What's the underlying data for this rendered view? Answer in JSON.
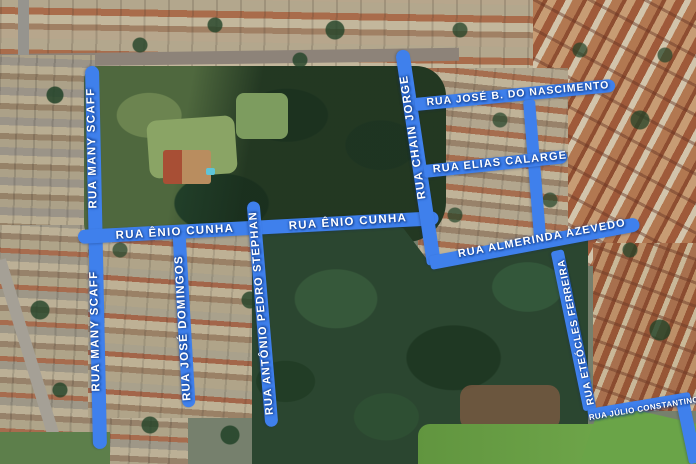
{
  "map": {
    "description": "Aerial satellite view with highlighted streets",
    "highlight_color": "#3f80ec",
    "label_text_color": "#ffffff",
    "street_names": [
      "RUA MANY SCAFF",
      "RUA ÊNIO CUNHA",
      "RUA JOSÉ DOMINGOS",
      "RUA ANTÔNIO PEDRO STEPHAN",
      "RUA CHAIN JORGE",
      "RUA JOSÉ B. DO NASCIMENTO",
      "RUA ELIAS CALARGE",
      "RUA ALMERINDA AZEVEDO",
      "RUA ETEÓCLES FERREIRA",
      "RUA JÚLIO CONSTANTINO"
    ],
    "segments": [
      {
        "id": "rua-many-scaff",
        "x": 92,
        "y": 66,
        "len": 383,
        "ang": 88.8,
        "w": 14,
        "cap": "both"
      },
      {
        "id": "rua-enio-cunha",
        "x": 78,
        "y": 237,
        "len": 361,
        "ang": -3.0,
        "w": 14,
        "cap": "both"
      },
      {
        "id": "rua-chain-jorge",
        "x": 402,
        "y": 50,
        "len": 217,
        "ang": 81.5,
        "w": 14,
        "cap": "start"
      },
      {
        "id": "rua-jose-b-do-nascimento",
        "x": 415,
        "y": 104,
        "len": 201,
        "ang": -5.5,
        "w": 13,
        "cap": "end"
      },
      {
        "id": "connector-nascimento-almerinda",
        "x": 529,
        "y": 100,
        "len": 149,
        "ang": 85.4,
        "w": 12,
        "cap": "none"
      },
      {
        "id": "rua-elias-calarge",
        "x": 424,
        "y": 171,
        "len": 144,
        "ang": -6.0,
        "w": 13,
        "cap": "end"
      },
      {
        "id": "rua-almerinda-azevedo",
        "x": 430,
        "y": 263,
        "len": 213,
        "ang": -10.6,
        "w": 14,
        "cap": "end"
      },
      {
        "id": "rua-jose-domingos",
        "x": 179,
        "y": 232,
        "len": 175,
        "ang": 86.7,
        "w": 13,
        "cap": "end"
      },
      {
        "id": "rua-antonio-pedro-stephan",
        "x": 253,
        "y": 201,
        "len": 226,
        "ang": 85.2,
        "w": 13,
        "cap": "both"
      },
      {
        "id": "rua-eteocles-ferreira",
        "x": 557,
        "y": 250,
        "len": 163,
        "ang": 78.3,
        "w": 13,
        "cap": "none"
      },
      {
        "id": "rua-julio-constantino",
        "x": 588,
        "y": 414,
        "len": 104,
        "ang": -9.5,
        "w": 10,
        "cap": "none"
      },
      {
        "id": "rua-julio-constantino-edge",
        "x": 682,
        "y": 398,
        "len": 66,
        "ang": 78.0,
        "w": 13,
        "cap": "none"
      }
    ],
    "labels": [
      {
        "id": "rua-many-scaff-upper",
        "text": "RUA MANY SCAFF",
        "x": 93,
        "y": 148,
        "rot": -91.2,
        "size": 11.5,
        "ls": 1.3
      },
      {
        "id": "rua-many-scaff-lower",
        "text": "RUA MANY SCAFF",
        "x": 96,
        "y": 331,
        "rot": -91.2,
        "size": 11.5,
        "ls": 1.3
      },
      {
        "id": "rua-enio-cunha-west",
        "text": "RUA ÊNIO CUNHA",
        "x": 175,
        "y": 233,
        "rot": -3.5,
        "size": 11.5,
        "ls": 1.3
      },
      {
        "id": "rua-enio-cunha-east",
        "text": "RUA ÊNIO CUNHA",
        "x": 348,
        "y": 223,
        "rot": -4.0,
        "size": 11.5,
        "ls": 1.3
      },
      {
        "id": "rua-chain-jorge",
        "text": "RUA CHAIN JORGE",
        "x": 414,
        "y": 137,
        "rot": -98.5,
        "size": 11.5,
        "ls": 1.2
      },
      {
        "id": "rua-jose-b-do-nascimento",
        "text": "RUA JOSÉ B. DO NASCIMENTO",
        "x": 518,
        "y": 94,
        "rot": -5.5,
        "size": 10.5,
        "ls": 1.0
      },
      {
        "id": "rua-elias-calarge",
        "text": "RUA ELIAS CALARGE",
        "x": 500,
        "y": 163,
        "rot": -6.0,
        "size": 11.0,
        "ls": 1.1
      },
      {
        "id": "rua-almerinda-azevedo",
        "text": "RUA ALMERINDA AZEVEDO",
        "x": 542,
        "y": 239,
        "rot": -10.6,
        "size": 11.0,
        "ls": 1.1
      },
      {
        "id": "rua-jose-domingos",
        "text": "RUA JOSÉ DOMINGOS",
        "x": 184,
        "y": 328,
        "rot": -93.3,
        "size": 11.5,
        "ls": 1.2
      },
      {
        "id": "rua-antonio-pedro-stephan",
        "text": "RUA ANTÔNIO PEDRO STEPHAN",
        "x": 262,
        "y": 313,
        "rot": -94.8,
        "size": 11.0,
        "ls": 1.2
      },
      {
        "id": "rua-eteocles-ferreira",
        "text": "RUA ETEÓCLES FERREIRA",
        "x": 577,
        "y": 332,
        "rot": -101.7,
        "size": 10.0,
        "ls": 0.8
      },
      {
        "id": "rua-julio-constantino",
        "text": "RUA JÚLIO CONSTANTINO",
        "x": 644,
        "y": 409,
        "rot": -9.5,
        "size": 8.0,
        "ls": 0.4
      }
    ]
  }
}
